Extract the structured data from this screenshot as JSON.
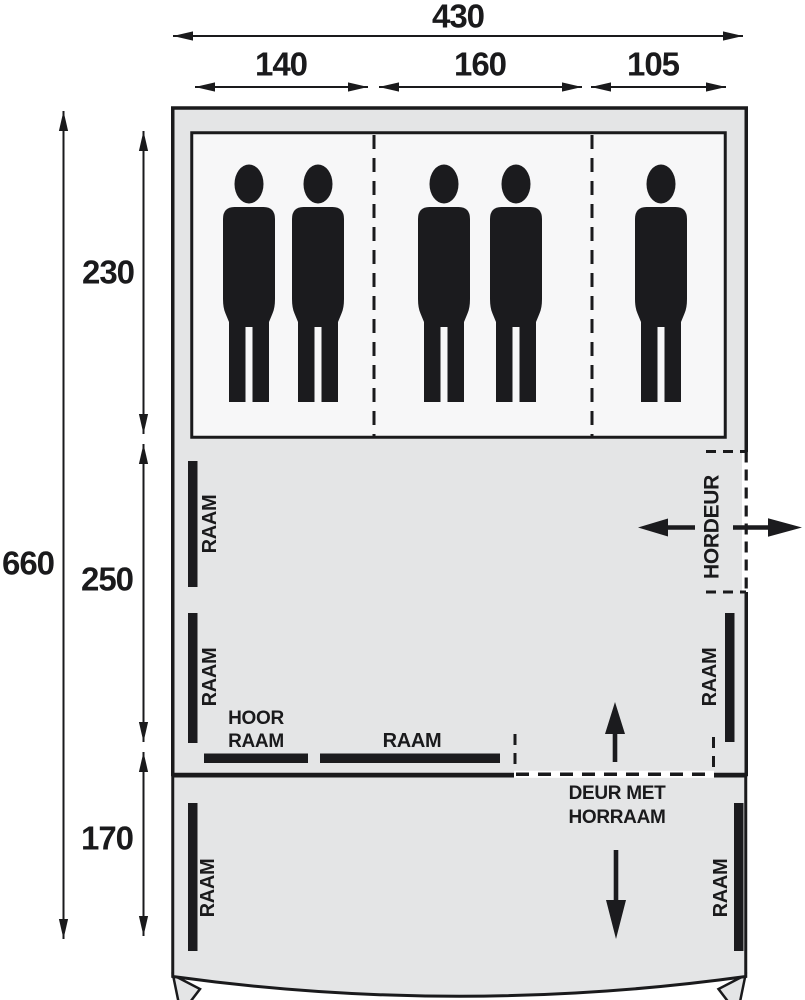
{
  "diagram": {
    "type": "tent-floorplan",
    "top_dimensions": {
      "total": "430",
      "sections": [
        "140",
        "160",
        "105"
      ]
    },
    "left_dimensions": {
      "total": "660",
      "sections": [
        "230",
        "250",
        "170"
      ]
    },
    "labels": {
      "window": "RAAM",
      "high_window_line1": "HOOR",
      "high_window_line2": "RAAM",
      "screen_door": "HORDEUR",
      "door_line1": "DEUR MET",
      "door_line2": "HORRAAM"
    },
    "occupant_count": 5,
    "colors": {
      "outline": "#1a1a1c",
      "tent_fill": "#e4e5e6",
      "sleeping_fill": "#f7f7f8",
      "figure": "#1b1b1e",
      "background": "#ffffff"
    }
  }
}
